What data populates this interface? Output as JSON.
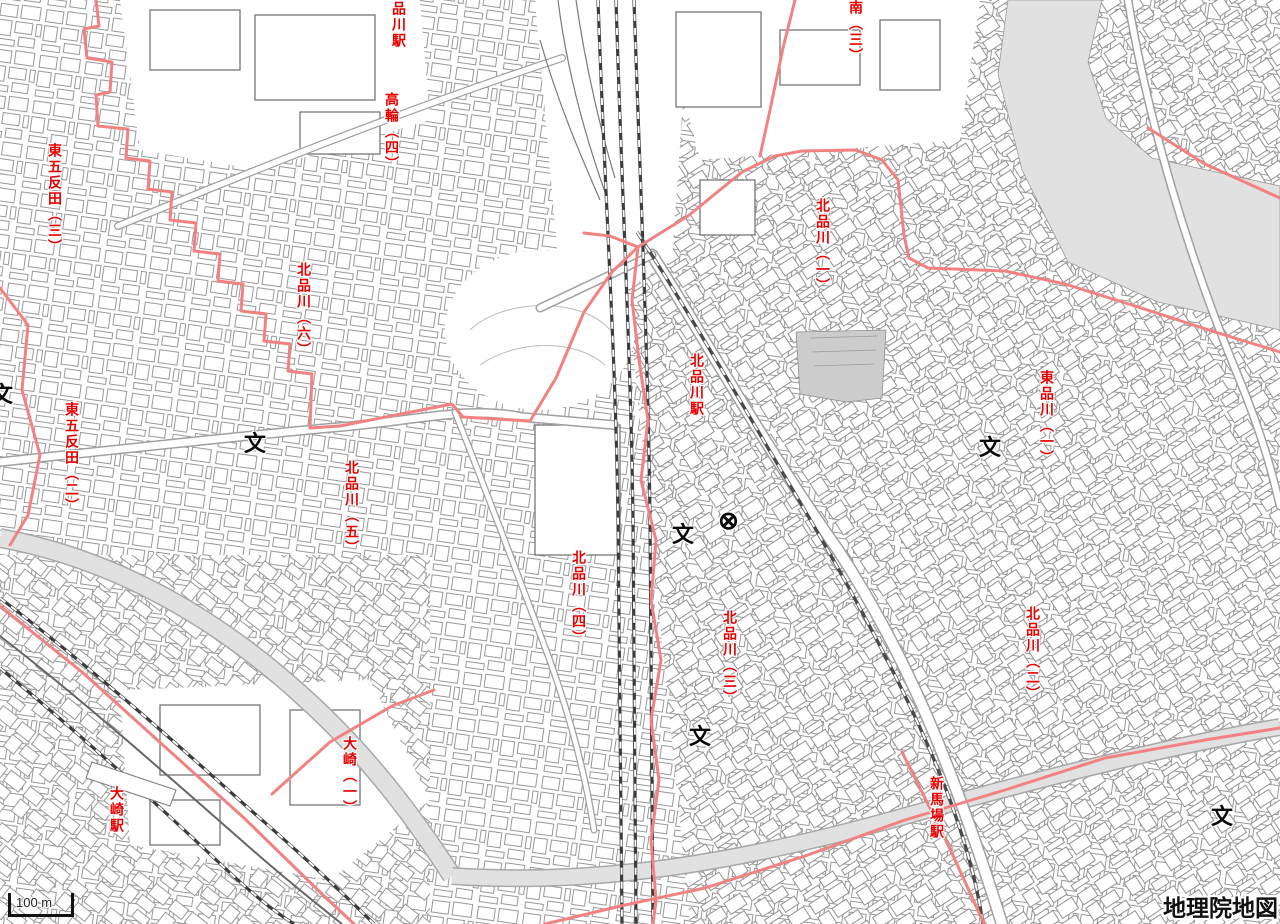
{
  "map": {
    "attribution": "地理院地図",
    "scale_bar_label": "100 m",
    "colors": {
      "label_red": "#e60000",
      "boundary_red": "#f28181",
      "water_gray": "#e1e1e1",
      "rail_dark": "#3c3c3c",
      "building_gray": "#989898"
    },
    "icons": {
      "school_glyph": "文",
      "police_glyph": "⊗"
    },
    "labels": [
      {
        "text": "品川駅",
        "kind": "station"
      },
      {
        "text": "高輪（四）",
        "kind": "district"
      },
      {
        "text": "南（三）",
        "kind": "district"
      },
      {
        "text": "東五反田（三）",
        "kind": "district"
      },
      {
        "text": "北品川（六）",
        "kind": "district"
      },
      {
        "text": "北品川（一）",
        "kind": "district"
      },
      {
        "text": "北品川駅",
        "kind": "station"
      },
      {
        "text": "東品川（一）",
        "kind": "district"
      },
      {
        "text": "東五反田（二）",
        "kind": "district"
      },
      {
        "text": "北品川（五）",
        "kind": "district"
      },
      {
        "text": "北品川（四）",
        "kind": "district"
      },
      {
        "text": "北品川（三）",
        "kind": "district"
      },
      {
        "text": "北品川（二）",
        "kind": "district"
      },
      {
        "text": "大崎（一）",
        "kind": "district"
      },
      {
        "text": "大崎駅",
        "kind": "station"
      },
      {
        "text": "新馬場駅",
        "kind": "station"
      }
    ]
  }
}
